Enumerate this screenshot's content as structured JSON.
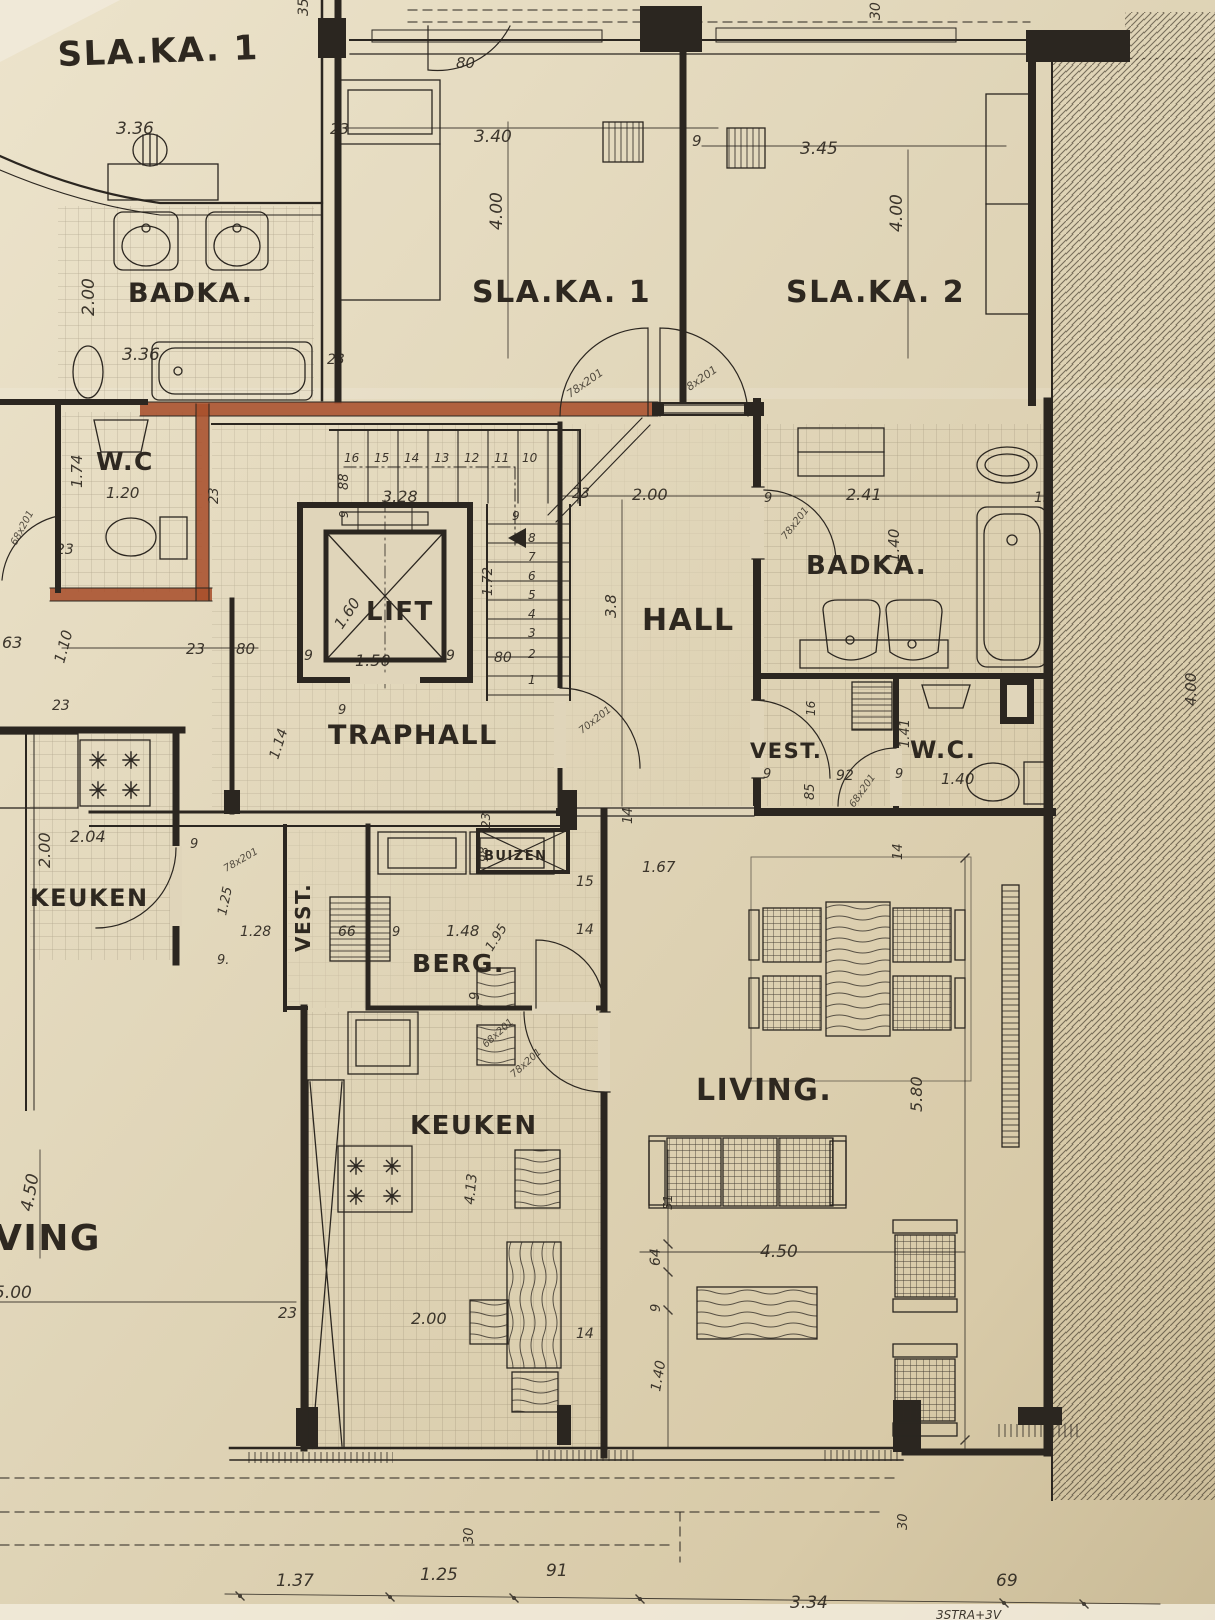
{
  "meta": {
    "document_type": "architectural floor plan (hand-drawn blueprint, photographed)",
    "language": "Dutch (Flemish)"
  },
  "colors": {
    "paper": "#e0d5ba",
    "ink": "#2b2620",
    "red_wall": "#a8502c"
  },
  "rooms": [
    {
      "label": "SLA.KA. 1",
      "note": "partial room, top-left",
      "dims": [
        "3.36",
        "2.00",
        "3.36"
      ]
    },
    {
      "label": "BADKA.",
      "note": "left bathroom",
      "fixtures": [
        "two washbasins",
        "bathtub",
        "stool",
        "basin"
      ]
    },
    {
      "label": "SLA.KA. 1",
      "dims": [
        "3.40",
        "4.00"
      ]
    },
    {
      "label": "SLA.KA. 2",
      "dims": [
        "3.45",
        "4.00"
      ]
    },
    {
      "label": "W.C",
      "note": "left, red-marked walls",
      "dims": [
        "1.74",
        "1.20"
      ]
    },
    {
      "label": "LIFT",
      "dims": [
        "1.60",
        "1.50"
      ]
    },
    {
      "label": "TRAPHALL",
      "dims": [
        "3.28",
        "1.14"
      ]
    },
    {
      "label": "HALL",
      "dims": [
        "2.00",
        "3.8",
        "1.67"
      ]
    },
    {
      "label": "BADKA.",
      "note": "right bathroom",
      "dims": [
        "2.41",
        "1.40"
      ]
    },
    {
      "label": "VEST.",
      "note": "right vestibule",
      "dims": [
        "85",
        "92"
      ]
    },
    {
      "label": "W.C.",
      "note": "right",
      "dims": [
        "1.41",
        "1.40"
      ]
    },
    {
      "label": "KEUKEN",
      "note": "left kitchen",
      "dims": [
        "2.04",
        "2.00",
        "1.28"
      ]
    },
    {
      "label": "VEST.",
      "note": "center vestibule",
      "dims": [
        "66"
      ]
    },
    {
      "label": "BERG.",
      "dims": [
        "1.48",
        "1.95"
      ]
    },
    {
      "label": "BUIZEN",
      "note": "pipe shaft"
    },
    {
      "label": "KEUKEN",
      "note": "center kitchen",
      "dims": [
        "2.00",
        "4.13"
      ]
    },
    {
      "label": "LIVING.",
      "dims": [
        "5.80",
        "4.50",
        "1.40",
        "64",
        "9"
      ]
    },
    {
      "label": "VING",
      "note": "cut-off LIVING of neighbouring flat",
      "dims": [
        "4.50",
        "5.00"
      ]
    }
  ],
  "doors": [
    "78x201",
    "78x201",
    "78x201",
    "68x201",
    "78x201",
    "68x201",
    "78x201",
    "68x201",
    "70x201"
  ],
  "stairs": {
    "upper_treads": [
      "16",
      "15",
      "14",
      "13",
      "12",
      "11",
      "10"
    ],
    "lower_treads": [
      "8",
      "7",
      "6",
      "5",
      "4",
      "3",
      "2",
      "1"
    ]
  },
  "bottom_dimension_chain": [
    "1.37",
    "1.25",
    "91",
    "3.34",
    "69"
  ],
  "street_note": "3STRA+3V",
  "annotations": [
    {
      "t": "SLA.KA. 1",
      "x": 58,
      "y": 66,
      "s": 34,
      "r": -2,
      "k": "room"
    },
    {
      "t": "BADKA.",
      "x": 128,
      "y": 302,
      "s": 27,
      "k": "room"
    },
    {
      "t": "SLA.KA. 1",
      "x": 472,
      "y": 302,
      "s": 30,
      "k": "room"
    },
    {
      "t": "SLA.KA. 2",
      "x": 786,
      "y": 302,
      "s": 30,
      "k": "room"
    },
    {
      "t": "W.C",
      "x": 96,
      "y": 470,
      "s": 25,
      "k": "room"
    },
    {
      "t": "LIFT",
      "x": 366,
      "y": 620,
      "s": 26,
      "k": "room"
    },
    {
      "t": "TRAPHALL",
      "x": 328,
      "y": 744,
      "s": 27,
      "k": "room"
    },
    {
      "t": "HALL",
      "x": 642,
      "y": 630,
      "s": 30,
      "k": "room"
    },
    {
      "t": "BADKA.",
      "x": 806,
      "y": 574,
      "s": 26,
      "k": "room"
    },
    {
      "t": "VEST.",
      "x": 750,
      "y": 758,
      "s": 21,
      "k": "room"
    },
    {
      "t": "W.C.",
      "x": 910,
      "y": 758,
      "s": 24,
      "k": "room"
    },
    {
      "t": "KEUKEN",
      "x": 30,
      "y": 906,
      "s": 24,
      "k": "room"
    },
    {
      "t": "VEST.",
      "x": 310,
      "y": 952,
      "s": 20,
      "r": -90,
      "k": "room"
    },
    {
      "t": "BERG.",
      "x": 412,
      "y": 972,
      "s": 25,
      "k": "room"
    },
    {
      "t": "BUIZEN",
      "x": 484,
      "y": 860,
      "s": 13,
      "k": "room"
    },
    {
      "t": "KEUKEN",
      "x": 410,
      "y": 1134,
      "s": 26,
      "k": "room"
    },
    {
      "t": "LIVING.",
      "x": 696,
      "y": 1100,
      "s": 30,
      "k": "room"
    },
    {
      "t": "VING",
      "x": -6,
      "y": 1250,
      "s": 36,
      "k": "room"
    },
    {
      "t": "3.36",
      "x": 116,
      "y": 134,
      "s": 17
    },
    {
      "t": "2.00",
      "x": 94,
      "y": 316,
      "s": 17,
      "r": -90
    },
    {
      "t": "3.36",
      "x": 122,
      "y": 360,
      "s": 17
    },
    {
      "t": "35",
      "x": 308,
      "y": 16,
      "s": 14,
      "r": -90
    },
    {
      "t": "80",
      "x": 456,
      "y": 68,
      "s": 15
    },
    {
      "t": "23",
      "x": 330,
      "y": 134,
      "s": 15
    },
    {
      "t": "3.40",
      "x": 474,
      "y": 142,
      "s": 17
    },
    {
      "t": "4.00",
      "x": 502,
      "y": 230,
      "s": 17,
      "r": -90
    },
    {
      "t": "23",
      "x": 327,
      "y": 364,
      "s": 14
    },
    {
      "t": "9",
      "x": 692,
      "y": 146,
      "s": 15
    },
    {
      "t": "3.45",
      "x": 800,
      "y": 154,
      "s": 17
    },
    {
      "t": "4.00",
      "x": 902,
      "y": 232,
      "s": 17,
      "r": -90
    },
    {
      "t": "30",
      "x": 880,
      "y": 20,
      "s": 14,
      "r": -90
    },
    {
      "t": "1.74",
      "x": 82,
      "y": 488,
      "s": 15,
      "r": -90
    },
    {
      "t": "1.20",
      "x": 106,
      "y": 498,
      "s": 15
    },
    {
      "t": "23",
      "x": 218,
      "y": 504,
      "s": 13,
      "r": -90
    },
    {
      "t": "23",
      "x": 56,
      "y": 554,
      "s": 14
    },
    {
      "t": "63",
      "x": 2,
      "y": 648,
      "s": 16
    },
    {
      "t": "1.10",
      "x": 64,
      "y": 664,
      "s": 15,
      "r": -75
    },
    {
      "t": "23",
      "x": 186,
      "y": 654,
      "s": 15
    },
    {
      "t": "80",
      "x": 236,
      "y": 654,
      "s": 15
    },
    {
      "t": "88",
      "x": 348,
      "y": 490,
      "s": 13,
      "r": -90
    },
    {
      "t": "9",
      "x": 348,
      "y": 518,
      "s": 12,
      "r": -90
    },
    {
      "t": "3.28",
      "x": 382,
      "y": 502,
      "s": 16
    },
    {
      "t": "16",
      "x": 344,
      "y": 462,
      "s": 12
    },
    {
      "t": "15",
      "x": 374,
      "y": 462,
      "s": 12
    },
    {
      "t": "14",
      "x": 404,
      "y": 462,
      "s": 12
    },
    {
      "t": "13",
      "x": 434,
      "y": 462,
      "s": 12
    },
    {
      "t": "12",
      "x": 464,
      "y": 462,
      "s": 12
    },
    {
      "t": "11",
      "x": 494,
      "y": 462,
      "s": 12
    },
    {
      "t": "10",
      "x": 522,
      "y": 462,
      "s": 12
    },
    {
      "t": "9",
      "x": 512,
      "y": 520,
      "s": 12
    },
    {
      "t": "8",
      "x": 528,
      "y": 542,
      "s": 12
    },
    {
      "t": "7",
      "x": 528,
      "y": 561,
      "s": 12
    },
    {
      "t": "6",
      "x": 528,
      "y": 580,
      "s": 12
    },
    {
      "t": "5",
      "x": 528,
      "y": 599,
      "s": 12
    },
    {
      "t": "4",
      "x": 528,
      "y": 618,
      "s": 12
    },
    {
      "t": "3",
      "x": 528,
      "y": 637,
      "s": 12
    },
    {
      "t": "2",
      "x": 528,
      "y": 658,
      "s": 12
    },
    {
      "t": "1",
      "x": 528,
      "y": 684,
      "s": 12
    },
    {
      "t": "1.72",
      "x": 492,
      "y": 596,
      "s": 13,
      "r": -90
    },
    {
      "t": "80",
      "x": 494,
      "y": 662,
      "s": 14
    },
    {
      "t": "1.60",
      "x": 342,
      "y": 630,
      "s": 15,
      "r": -56
    },
    {
      "t": "1.50",
      "x": 355,
      "y": 666,
      "s": 16
    },
    {
      "t": "9",
      "x": 304,
      "y": 660,
      "s": 14
    },
    {
      "t": "9",
      "x": 446,
      "y": 660,
      "s": 14
    },
    {
      "t": "70x201",
      "x": 582,
      "y": 734,
      "s": 10,
      "r": -38,
      "k": "door"
    },
    {
      "t": "1.14",
      "x": 278,
      "y": 760,
      "s": 14,
      "r": -72
    },
    {
      "t": "9",
      "x": 338,
      "y": 714,
      "s": 13
    },
    {
      "t": "23",
      "x": 572,
      "y": 498,
      "s": 14
    },
    {
      "t": "2.00",
      "x": 632,
      "y": 500,
      "s": 16
    },
    {
      "t": "3.8",
      "x": 616,
      "y": 618,
      "s": 15,
      "r": -90
    },
    {
      "t": "1.67",
      "x": 642,
      "y": 872,
      "s": 15
    },
    {
      "t": "14",
      "x": 632,
      "y": 824,
      "s": 13,
      "r": -90
    },
    {
      "t": "14",
      "x": 902,
      "y": 860,
      "s": 13,
      "r": -90
    },
    {
      "t": "9",
      "x": 764,
      "y": 502,
      "s": 13
    },
    {
      "t": "78x201",
      "x": 786,
      "y": 540,
      "s": 10,
      "r": -52,
      "k": "door"
    },
    {
      "t": "2.41",
      "x": 846,
      "y": 500,
      "s": 16
    },
    {
      "t": "1.40",
      "x": 899,
      "y": 562,
      "s": 15,
      "r": -90
    },
    {
      "t": "15",
      "x": 1034,
      "y": 502,
      "s": 14
    },
    {
      "t": "16",
      "x": 815,
      "y": 716,
      "s": 12,
      "r": -90
    },
    {
      "t": "9",
      "x": 763,
      "y": 778,
      "s": 13
    },
    {
      "t": "85",
      "x": 814,
      "y": 800,
      "s": 13,
      "r": -90
    },
    {
      "t": "92",
      "x": 836,
      "y": 780,
      "s": 14
    },
    {
      "t": "68x201",
      "x": 854,
      "y": 808,
      "s": 10,
      "r": -55,
      "k": "door"
    },
    {
      "t": "1.41",
      "x": 909,
      "y": 748,
      "s": 13,
      "r": -90
    },
    {
      "t": "1.40",
      "x": 941,
      "y": 784,
      "s": 15
    },
    {
      "t": "9",
      "x": 895,
      "y": 778,
      "s": 13
    },
    {
      "t": "4.00",
      "x": 1196,
      "y": 706,
      "s": 15,
      "r": -90
    },
    {
      "t": "23",
      "x": 52,
      "y": 710,
      "s": 14
    },
    {
      "t": "2.04",
      "x": 70,
      "y": 842,
      "s": 16
    },
    {
      "t": "2.00",
      "x": 50,
      "y": 868,
      "s": 16,
      "r": -90
    },
    {
      "t": "9",
      "x": 190,
      "y": 848,
      "s": 13
    },
    {
      "t": "78x201",
      "x": 226,
      "y": 872,
      "s": 10,
      "r": -30,
      "k": "door"
    },
    {
      "t": "1.25",
      "x": 226,
      "y": 916,
      "s": 13,
      "r": -78
    },
    {
      "t": "1.28",
      "x": 240,
      "y": 936,
      "s": 14
    },
    {
      "t": "9.",
      "x": 217,
      "y": 964,
      "s": 13
    },
    {
      "t": "66",
      "x": 338,
      "y": 936,
      "s": 14
    },
    {
      "t": "9",
      "x": 392,
      "y": 936,
      "s": 13
    },
    {
      "t": "1.48",
      "x": 446,
      "y": 936,
      "s": 15
    },
    {
      "t": "1.95",
      "x": 492,
      "y": 952,
      "s": 13,
      "r": -58
    },
    {
      "t": "9",
      "x": 479,
      "y": 1000,
      "s": 13,
      "r": -90
    },
    {
      "t": "23",
      "x": 490,
      "y": 828,
      "s": 12,
      "r": -90
    },
    {
      "t": "98",
      "x": 488,
      "y": 862,
      "s": 12,
      "r": -90
    },
    {
      "t": "68x201",
      "x": 486,
      "y": 1048,
      "s": 10,
      "r": -42,
      "k": "door"
    },
    {
      "t": "78x201",
      "x": 514,
      "y": 1078,
      "s": 10,
      "r": -42,
      "k": "door"
    },
    {
      "t": "15",
      "x": 576,
      "y": 886,
      "s": 14
    },
    {
      "t": "14",
      "x": 576,
      "y": 934,
      "s": 14
    },
    {
      "t": "4.13",
      "x": 474,
      "y": 1205,
      "s": 14,
      "r": -85
    },
    {
      "t": "2.00",
      "x": 411,
      "y": 1324,
      "s": 16
    },
    {
      "t": "23",
      "x": 278,
      "y": 1318,
      "s": 15
    },
    {
      "t": "14",
      "x": 576,
      "y": 1338,
      "s": 14
    },
    {
      "t": "5.80",
      "x": 922,
      "y": 1112,
      "s": 16,
      "r": -90
    },
    {
      "t": "4.50",
      "x": 760,
      "y": 1257,
      "s": 17
    },
    {
      "t": "64",
      "x": 660,
      "y": 1266,
      "s": 14,
      "r": -90
    },
    {
      "t": "9",
      "x": 660,
      "y": 1312,
      "s": 13,
      "r": -90
    },
    {
      "t": "1.40",
      "x": 660,
      "y": 1392,
      "s": 14,
      "r": -80
    },
    {
      "t": "51",
      "x": 672,
      "y": 1210,
      "s": 12,
      "r": -90
    },
    {
      "t": "4.50",
      "x": 32,
      "y": 1212,
      "s": 17,
      "r": -80
    },
    {
      "t": "5.00",
      "x": -6,
      "y": 1298,
      "s": 17
    },
    {
      "t": "1.37",
      "x": 276,
      "y": 1586,
      "s": 17
    },
    {
      "t": "1.25",
      "x": 420,
      "y": 1580,
      "s": 17
    },
    {
      "t": "91",
      "x": 546,
      "y": 1576,
      "s": 17
    },
    {
      "t": "3.34",
      "x": 790,
      "y": 1608,
      "s": 17
    },
    {
      "t": "69",
      "x": 996,
      "y": 1586,
      "s": 17
    },
    {
      "t": "30",
      "x": 473,
      "y": 1544,
      "s": 13,
      "r": -90
    },
    {
      "t": "30",
      "x": 907,
      "y": 1530,
      "s": 13,
      "r": -90
    },
    {
      "t": "3STRA+3V",
      "x": 936,
      "y": 1619,
      "s": 12
    },
    {
      "t": "1.40",
      "x": 0,
      "y": 442,
      "s": 12,
      "r": -90
    },
    {
      "t": "78x201",
      "x": 570,
      "y": 398,
      "s": 11,
      "r": -35,
      "k": "door"
    },
    {
      "t": "78x201",
      "x": 684,
      "y": 395,
      "s": 11,
      "r": -35,
      "k": "door"
    },
    {
      "t": "68x201",
      "x": 16,
      "y": 546,
      "s": 10,
      "r": -62,
      "k": "door"
    }
  ]
}
